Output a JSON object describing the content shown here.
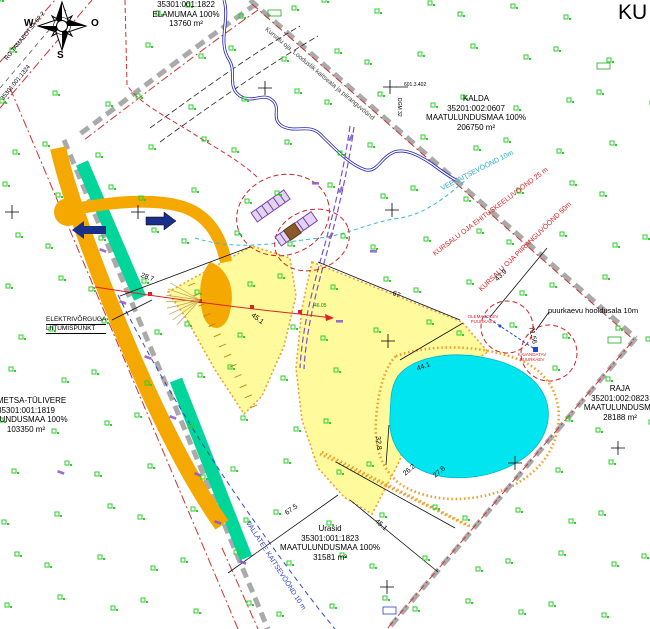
{
  "sheet_title": "KU",
  "compass": {
    "north": "N",
    "south": "S",
    "west": "W",
    "east": "O"
  },
  "parcels": {
    "elamumaa": {
      "lines": [
        "35301:001:1822",
        "ELAMUMAA 100%",
        "13760 m²"
      ]
    },
    "kalda": {
      "lines": [
        "KALDA",
        "35201:002:0607",
        "MAATULUNDUSMAA 100%",
        "206750 m²"
      ]
    },
    "sumetsa": {
      "lines": [
        "SUMETSA-TÜLIVERE",
        "35301:001:1819",
        "TULUNDUSMAA 100%",
        "103350 m²"
      ]
    },
    "urasid": {
      "lines": [
        "Urasid",
        "35301:001:1823",
        "MAATULUNDUSMAA 100%",
        "31581 m²"
      ]
    },
    "raja": {
      "lines": [
        "RAJA",
        "35201:002:0823",
        "MAATULUNDUSMA",
        "28188 m²"
      ]
    }
  },
  "zones": {
    "stream_label": "Kursalu oja. Looduslik kaitseala ja piiranguvöönd",
    "water_protection": "VEEKAITSEVÖÖND 10m",
    "building_ban": "KURSALU OJA EHITUSKEELUVÖÖND 25 m",
    "restriction": "KURSALU OJA PIIRANGUVÖÖND 50m",
    "road_protection": "VALLATEE KAITSEVÖÖND 10 m",
    "well_maintenance": "puurkaevu hooldusala 10m"
  },
  "annotations": {
    "electric": {
      "lines": [
        "ELEKTRIVÕRGUGA",
        "LIITUMISPUNKT"
      ]
    },
    "existing_well": {
      "lines": [
        "OLEMASOLEV",
        "PUURKAEV"
      ]
    },
    "planned_well": {
      "lines": [
        "KAVANDATAV",
        "PUURKAEV"
      ]
    },
    "road_ref": "RG TAMAEOTSA 62-2",
    "road_ref2": "35301:001:1324",
    "benchmark": "601.3.402",
    "point_code": "DGM 32",
    "green_note": "46.05"
  },
  "dimensions": [
    "28.7",
    "67",
    "43.9",
    "44.1",
    "32.8",
    "26.2",
    "27.6",
    "67.5",
    "45.1",
    "45.1",
    "71.56"
  ],
  "colors": {
    "plot_yellow": "#FFFB9C",
    "pond_cyan": "#00E5F0",
    "road_orange": "#F5A800",
    "strip_teal": "#00D59A",
    "boundary_grey": "#AAAAAA",
    "boundary_red": "#CC3333",
    "vegetation_green": "#2ECC2E",
    "zone_red": "#DD2222",
    "zone_cyan": "#2AA8C8",
    "zone_blue": "#3344CC",
    "utility_purple": "#8855CC"
  }
}
